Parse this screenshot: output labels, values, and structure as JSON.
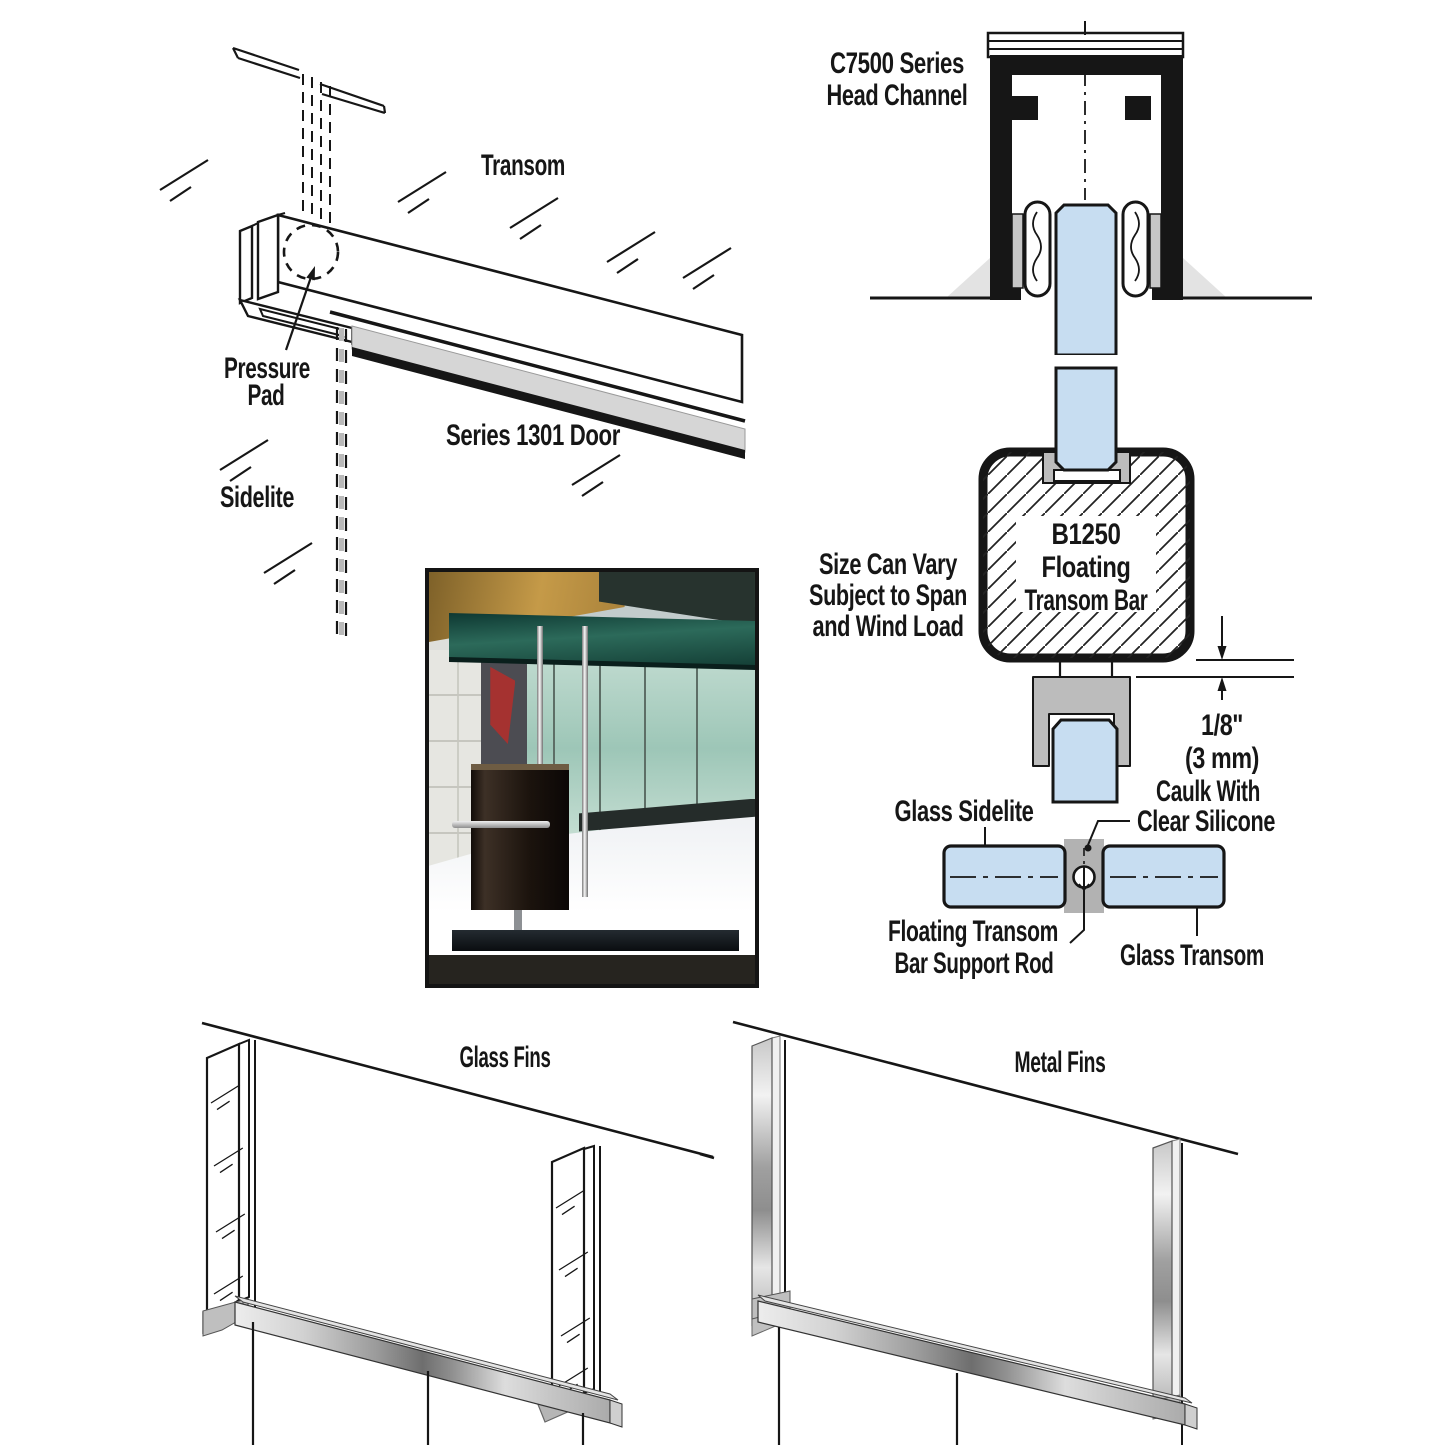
{
  "colors": {
    "glass_blue": "#c7ddf1",
    "fitting_gray": "#bcbcbc",
    "ink": "#161616",
    "background": "#ffffff"
  },
  "iso": {
    "transom": "Transom",
    "pressure1": "Pressure",
    "pressure2": "Pad",
    "series_door": "Series 1301 Door",
    "sidelite": "Sidelite"
  },
  "cross": {
    "head1": "C7500 Series",
    "head2": "Head Channel",
    "size1": "Size Can Vary",
    "size2": "Subject to Span",
    "size3": "and Wind Load",
    "bar1": "B1250",
    "bar2": "Floating",
    "bar3": "Transom Bar",
    "dim1": "1/8\"",
    "dim2": "(3 mm)",
    "sidelite": "Glass Sidelite",
    "caulk1": "Caulk With",
    "caulk2": "Clear Silicone",
    "rod1": "Floating Transom",
    "rod2": "Bar Support Rod",
    "transom": "Glass Transom"
  },
  "fins": {
    "glass": "Glass Fins",
    "metal": "Metal Fins"
  }
}
